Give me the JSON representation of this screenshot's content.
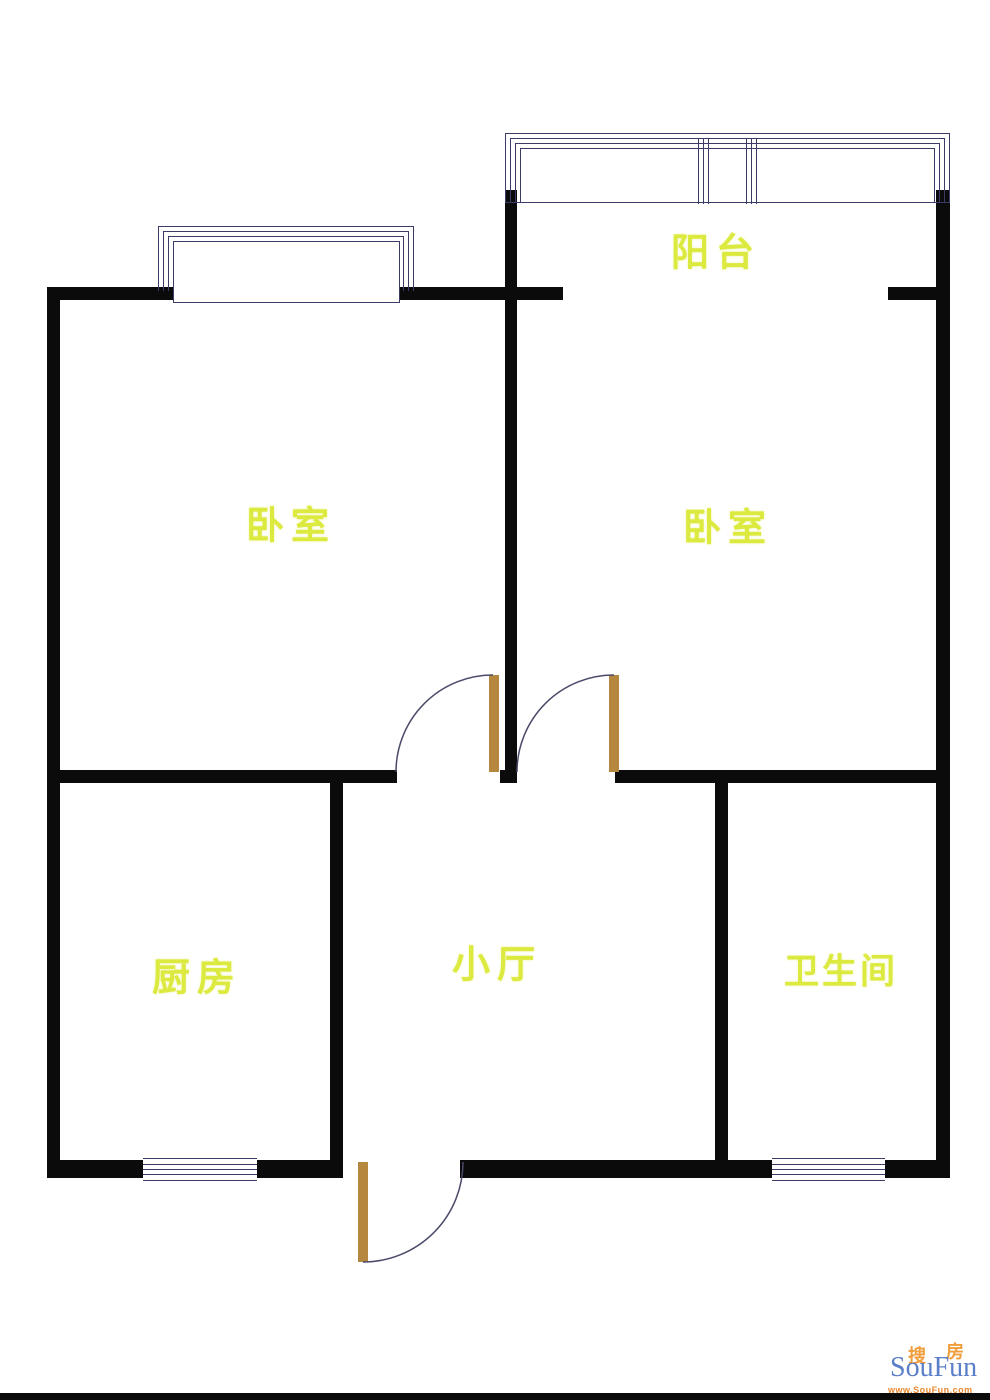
{
  "page": {
    "background": "#ffffff",
    "width": 990,
    "height": 1400
  },
  "floorplan": {
    "type": "apartment-floor-plan",
    "rooms": {
      "balcony": {
        "label": "阳台"
      },
      "bedroom_left": {
        "label": "卧室"
      },
      "bedroom_right": {
        "label": "卧室"
      },
      "kitchen": {
        "label": "厨房"
      },
      "hall": {
        "label": "小厅"
      },
      "bathroom": {
        "label": "卫生间"
      }
    },
    "colors": {
      "wall": "#0b0b0b",
      "window_line": "#3b3b68",
      "door": "#b6883f",
      "arc": "#4a4a6a",
      "label": "#dce93f"
    }
  },
  "watermark": {
    "cn_first": "搜",
    "cn_second": "房",
    "brand": "SouFun",
    "url": "www.SouFun.com",
    "brand_color": "#5b7ec8",
    "accent_color": "#f09d3c",
    "url_color": "#e8872e"
  }
}
